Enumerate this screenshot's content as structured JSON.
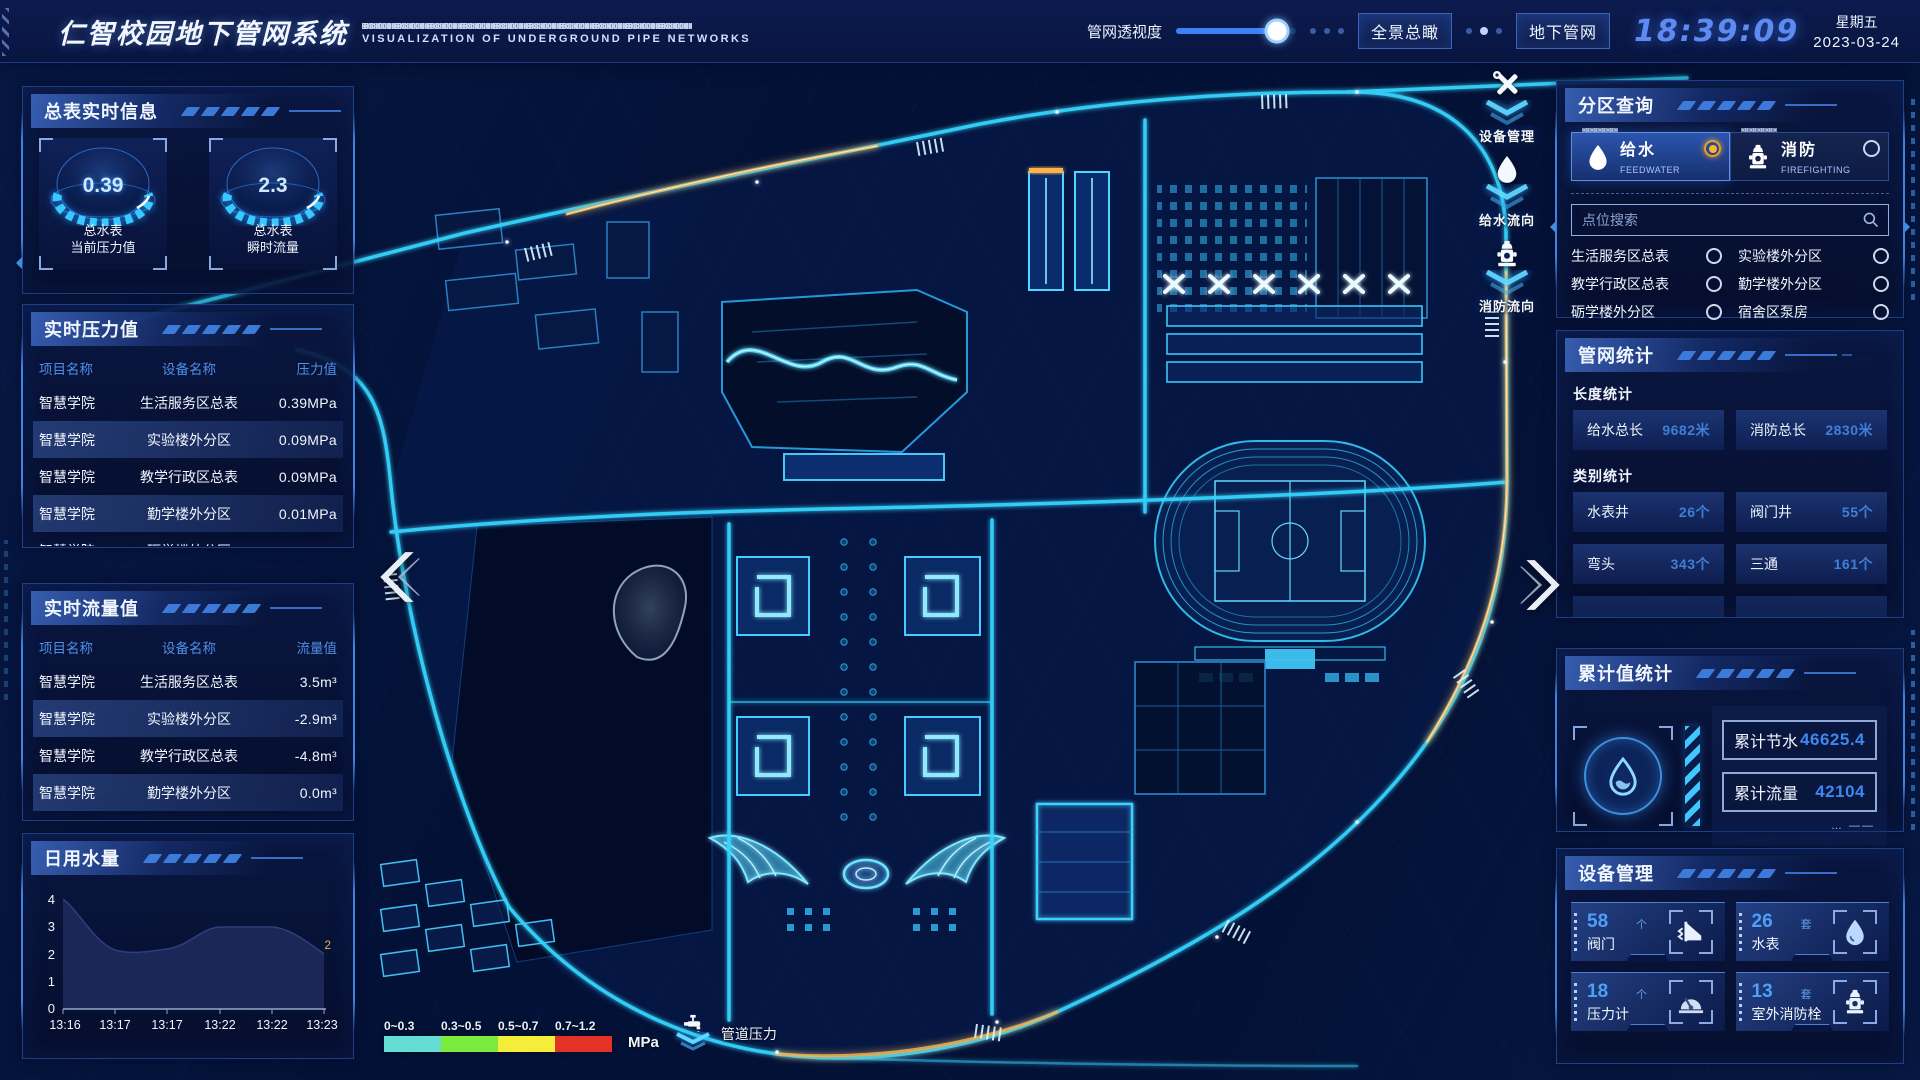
{
  "header": {
    "title": "仁智校园地下管网系统",
    "subtitle": "VISUALIZATION OF UNDERGROUND PIPE NETWORKS",
    "transparency_label": "管网透视度",
    "overview_button": "全景总瞰",
    "underground_button": "地下管网",
    "time": "18:39:09",
    "weekday": "星期五",
    "date": "2023-03-24"
  },
  "left": {
    "meter_panel": {
      "title": "总表实时信息",
      "gauges": [
        {
          "value": "0.39",
          "line1": "总水表",
          "line2": "当前压力值"
        },
        {
          "value": "2.3",
          "line1": "总水表",
          "line2": "瞬时流量"
        }
      ]
    },
    "pressure_panel": {
      "title": "实时压力值",
      "columns": [
        "项目名称",
        "设备名称",
        "压力值"
      ],
      "rows": [
        [
          "智慧学院",
          "生活服务区总表",
          "0.39MPa"
        ],
        [
          "智慧学院",
          "实验楼外分区",
          "0.09MPa"
        ],
        [
          "智慧学院",
          "教学行政区总表",
          "0.09MPa"
        ],
        [
          "智慧学院",
          "勤学楼外分区",
          "0.01MPa"
        ],
        [
          "智慧学院",
          "砺学楼外分区",
          "0.00MPa"
        ]
      ]
    },
    "flow_panel": {
      "title": "实时流量值",
      "columns": [
        "项目名称",
        "设备名称",
        "流量值"
      ],
      "rows": [
        [
          "智慧学院",
          "生活服务区总表",
          "3.5m³"
        ],
        [
          "智慧学院",
          "实验楼外分区",
          "-2.9m³"
        ],
        [
          "智慧学院",
          "教学行政区总表",
          "-4.8m³"
        ],
        [
          "智慧学院",
          "勤学楼外分区",
          "0.0m³"
        ],
        [
          "智慧学院",
          "砺学楼外分区",
          "2.3m³"
        ]
      ]
    },
    "daily_panel": {
      "title": "日用水量"
    }
  },
  "chart_data": {
    "type": "area",
    "title": "日用水量",
    "x": [
      "13:16",
      "13:17",
      "13:17",
      "13:22",
      "13:22",
      "13:23"
    ],
    "values": [
      4,
      2.2,
      2.2,
      3,
      3,
      2
    ],
    "y_ticks": [
      4,
      3,
      2,
      1,
      0
    ],
    "ylim": [
      0,
      4
    ],
    "end_label": "2",
    "area_color": "#1c2a5a",
    "end_label_color": "#d8b63f"
  },
  "map": {
    "flow_buttons": [
      {
        "label": "设备管理"
      },
      {
        "label": "给水流向"
      },
      {
        "label": "消防流向"
      }
    ],
    "legend": {
      "ranges": [
        "0~0.3",
        "0.3~0.5",
        "0.5~0.7",
        "0.7~1.2"
      ],
      "colors": [
        "#63dcd3",
        "#7ceb3f",
        "#f4ee3b",
        "#e23325"
      ],
      "unit": "MPa",
      "pressure_label": "管道压力"
    }
  },
  "right": {
    "zone_panel": {
      "title": "分区查询",
      "tabs": [
        {
          "label": "给水",
          "sub": "FEEDWATER",
          "selected": true
        },
        {
          "label": "消防",
          "sub": "FIREFIGHTING",
          "selected": false
        }
      ],
      "search_placeholder": "点位搜索",
      "items": [
        "生活服务区总表",
        "实验楼外分区",
        "教学行政区总表",
        "勤学楼外分区",
        "砺学楼外分区",
        "宿舍区泵房"
      ]
    },
    "network_panel": {
      "title": "管网统计",
      "length_section": "长度统计",
      "category_section": "类别统计",
      "length_stats": [
        {
          "label": "给水总长",
          "value": "9682米"
        },
        {
          "label": "消防总长",
          "value": "2830米"
        }
      ],
      "category_stats": [
        {
          "label": "水表井",
          "value": "26个"
        },
        {
          "label": "阀门井",
          "value": "55个"
        },
        {
          "label": "弯头",
          "value": "343个"
        },
        {
          "label": "三通",
          "value": "161个"
        }
      ]
    },
    "cumulative_panel": {
      "title": "累计值统计",
      "stats": [
        {
          "label": "累计节水",
          "value": "46625.4"
        },
        {
          "label": "累计流量",
          "value": "42104"
        }
      ]
    },
    "device_panel": {
      "title": "设备管理",
      "cards": [
        {
          "count": "58",
          "unit": "个",
          "label": "阀门"
        },
        {
          "count": "26",
          "unit": "套",
          "label": "水表"
        },
        {
          "count": "18",
          "unit": "个",
          "label": "压力计"
        },
        {
          "count": "13",
          "unit": "套",
          "label": "室外消防栓"
        }
      ]
    }
  }
}
